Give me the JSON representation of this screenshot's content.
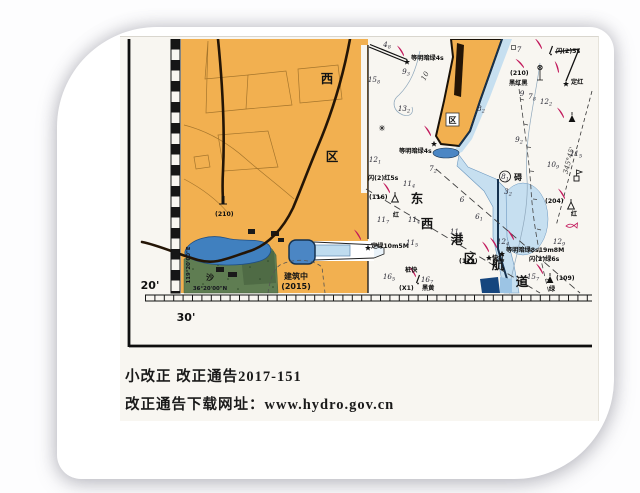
{
  "chart_number": "36144",
  "notes": {
    "line1": "小改正  改正通告2017-151",
    "line2": "改正通告下载网址：www.hydro.gov.cn"
  },
  "colors": {
    "land": "#f2b050",
    "road": "#241506",
    "shallow": "#c6dff0",
    "pond": "#4080bf",
    "dock": "#4b86c4",
    "deep_blob": "#16467e",
    "green": "#5f7d52",
    "green_dark": "#4f6b45",
    "flare": "#c2185b",
    "quay": "#16324f",
    "ink": "#141414",
    "contour": "#8fa8bc",
    "photo_bg": "#f8f6f1"
  },
  "graticule": {
    "lat_tick_label": "20'",
    "lon_tick_label": "30'",
    "lat_line_label": "36°20'00\"N",
    "lon_line_label": "119°20'00\"E"
  },
  "chart_labels": [
    {
      "t": "西",
      "x": 199,
      "y": 44,
      "c": "big",
      "a": "m",
      "n": "area-label-xi-west"
    },
    {
      "t": "区",
      "x": 204,
      "y": 122,
      "c": "big",
      "a": "m",
      "n": "area-label-qu-district"
    },
    {
      "t": "东",
      "x": 289,
      "y": 164,
      "c": "big",
      "a": "m",
      "n": "channel-label-dong"
    },
    {
      "t": "西",
      "x": 299,
      "y": 189,
      "c": "big",
      "a": "m",
      "n": "channel-label-xi"
    },
    {
      "t": "港",
      "x": 329,
      "y": 205,
      "c": "big",
      "a": "m",
      "n": "channel-label-gang"
    },
    {
      "t": "区",
      "x": 342,
      "y": 224,
      "c": "big",
      "a": "m",
      "n": "channel-label-qu"
    },
    {
      "t": "航",
      "x": 370,
      "y": 230,
      "c": "big",
      "a": "m",
      "n": "channel-label-hang"
    },
    {
      "t": "道",
      "x": 394,
      "y": 247,
      "c": "big",
      "a": "m",
      "n": "channel-label-dao"
    },
    {
      "t": "碍",
      "x": 390,
      "y": 141,
      "c": "med",
      "a": "m",
      "n": "obstruction-label"
    },
    {
      "t": "沙",
      "x": 82,
      "y": 241,
      "c": "med",
      "a": "m",
      "n": "sand-label"
    },
    {
      "t": "区",
      "x": 324.5,
      "y": 84,
      "c": "med",
      "a": "m",
      "n": "pier-district-label"
    },
    {
      "t": "建筑中",
      "x": 168,
      "y": 240,
      "c": "med",
      "a": "m",
      "n": "under-construction-label"
    },
    {
      "t": "(2015)",
      "x": 168,
      "y": 250,
      "c": "med",
      "a": "m",
      "n": "construction-year-label"
    },
    {
      "t": "等明暗绿4s",
      "x": 283,
      "y": 21,
      "c": "nav",
      "n": "light-label-isophase-green-4s-breakwater"
    },
    {
      "t": "等明暗绿4s",
      "x": 271,
      "y": 114,
      "c": "nav",
      "n": "light-label-isophase-green-4s-pier"
    },
    {
      "t": "闪(2)5s",
      "x": 428,
      "y": 14,
      "c": "nav",
      "n": "light-label-fl2-5s"
    },
    {
      "t": "定红",
      "x": 443,
      "y": 45,
      "c": "nav",
      "n": "light-label-fixed-red"
    },
    {
      "t": "(210)",
      "x": 382,
      "y": 36,
      "c": "nav",
      "n": "beacon-elevation-210-label"
    },
    {
      "t": "黑红黑",
      "x": 381,
      "y": 46,
      "c": "nav",
      "n": "beacon-color-black-red-black-label"
    },
    {
      "t": "闪(2)红5s",
      "x": 240,
      "y": 141,
      "c": "nav",
      "n": "light-label-fl2-red-5s"
    },
    {
      "t": "(116)",
      "x": 241,
      "y": 160,
      "c": "nav",
      "n": "beacon-116-label"
    },
    {
      "t": "红",
      "x": 268,
      "y": 178,
      "c": "nav",
      "a": "m",
      "n": "beacon-116-red-label"
    },
    {
      "t": "定绿10m5M",
      "x": 243,
      "y": 209,
      "c": "nav",
      "n": "light-label-fixed-green-10m5M"
    },
    {
      "t": "桩快",
      "x": 277,
      "y": 233,
      "c": "nav",
      "n": "buoy-pile-quick-label"
    },
    {
      "t": "(X1)",
      "x": 271,
      "y": 251,
      "c": "nav",
      "n": "buoy-x1-label"
    },
    {
      "t": "黑黄",
      "x": 294,
      "y": 251,
      "c": "nav",
      "n": "buoy-black-yellow-label"
    },
    {
      "t": "(112)",
      "x": 331,
      "y": 224,
      "c": "nav",
      "n": "beacon-112-label"
    },
    {
      "t": "快红",
      "x": 364,
      "y": 221,
      "c": "nav",
      "n": "light-label-quick-red"
    },
    {
      "t": "等明暗绿8s19m8M",
      "x": 378,
      "y": 213,
      "c": "nav",
      "n": "light-label-isophase-green-8s19m8M"
    },
    {
      "t": "闪(2)绿6s",
      "x": 401,
      "y": 222,
      "c": "nav",
      "n": "light-label-fl2-green-6s"
    },
    {
      "t": "(109)",
      "x": 428,
      "y": 241,
      "c": "nav",
      "n": "beacon-109-label"
    },
    {
      "t": "绿",
      "x": 424,
      "y": 252,
      "c": "nav",
      "a": "m",
      "n": "beacon-109-green-label"
    },
    {
      "t": "(204)",
      "x": 417,
      "y": 164,
      "c": "nav",
      "n": "beacon-204-label"
    },
    {
      "t": "红",
      "x": 446,
      "y": 177,
      "c": "nav",
      "a": "m",
      "n": "beacon-204-red-label"
    },
    {
      "t": "(210)",
      "x": 87,
      "y": 177,
      "c": "nav",
      "n": "tower-elevation-210-label"
    },
    {
      "t": "10",
      "x": 299,
      "y": 38,
      "c": "ital",
      "r": -62,
      "a": "m",
      "n": "depth-contour-10m-label"
    },
    {
      "t": "345°45'",
      "x": 443,
      "y": 122,
      "c": "ital",
      "r": -75,
      "a": "m",
      "n": "bearing-line-label"
    },
    {
      "t": "36°20'00\"N",
      "x": 82,
      "y": 251,
      "c": "tiny",
      "a": "m",
      "n": "latitude-line-label"
    },
    {
      "t": "119°20'00\"E",
      "x": 62,
      "y": 226,
      "c": "tiny",
      "a": "m",
      "r": -90,
      "n": "longitude-line-label"
    },
    {
      "t": "20'",
      "x": 22,
      "y": 250,
      "c": "margin",
      "a": "m",
      "n": "latitude-tick-label"
    },
    {
      "t": "30'",
      "x": 58,
      "y": 282,
      "c": "margin",
      "a": "m",
      "n": "longitude-tick-label"
    }
  ],
  "soundings": [
    {
      "m": "15",
      "s": "8",
      "x": 246,
      "y": 43
    },
    {
      "m": "4",
      "s": "8",
      "x": 259,
      "y": 8
    },
    {
      "m": "9",
      "s": "3",
      "x": 278,
      "y": 35
    },
    {
      "m": "13",
      "s": "2",
      "x": 276,
      "y": 72
    },
    {
      "m": "8",
      "s": "2",
      "x": 353,
      "y": 72
    },
    {
      "m": "9",
      "s": "2",
      "x": 391,
      "y": 103
    },
    {
      "m": "12",
      "s": "2",
      "x": 418,
      "y": 65
    },
    {
      "m": "9",
      "x": 394,
      "y": 57
    },
    {
      "m": "7",
      "s": "8",
      "x": 404,
      "y": 60
    },
    {
      "m": "7",
      "x": 391,
      "y": 13
    },
    {
      "m": "12",
      "s": "1",
      "x": 247,
      "y": 123
    },
    {
      "m": "7",
      "s": "2",
      "x": 305,
      "y": 132
    },
    {
      "m": "11",
      "s": "4",
      "x": 281,
      "y": 147
    },
    {
      "m": "11",
      "s": "7",
      "x": 255,
      "y": 183
    },
    {
      "m": "11",
      "s": "4",
      "x": 286,
      "y": 183
    },
    {
      "m": "11",
      "s": "5",
      "x": 284,
      "y": 206
    },
    {
      "m": "6",
      "x": 334,
      "y": 163
    },
    {
      "m": "6",
      "s": "1",
      "x": 351,
      "y": 180
    },
    {
      "m": "11",
      "s": "9",
      "x": 328,
      "y": 195
    },
    {
      "m": "12",
      "s": "4",
      "x": 375,
      "y": 205
    },
    {
      "m": "11",
      "s": "5",
      "x": 448,
      "y": 117
    },
    {
      "m": "10",
      "s": "9",
      "x": 425,
      "y": 128
    },
    {
      "m": "3",
      "s": "2",
      "x": 380,
      "y": 155
    },
    {
      "m": "12",
      "s": "9",
      "x": 431,
      "y": 205
    },
    {
      "m": "15",
      "s": "7",
      "x": 405,
      "y": 240
    },
    {
      "m": "16",
      "s": "5",
      "x": 261,
      "y": 240
    },
    {
      "m": "16",
      "s": "7",
      "x": 299,
      "y": 243
    },
    {
      "m": "8",
      "s": "1",
      "x": 377,
      "y": 140
    }
  ]
}
